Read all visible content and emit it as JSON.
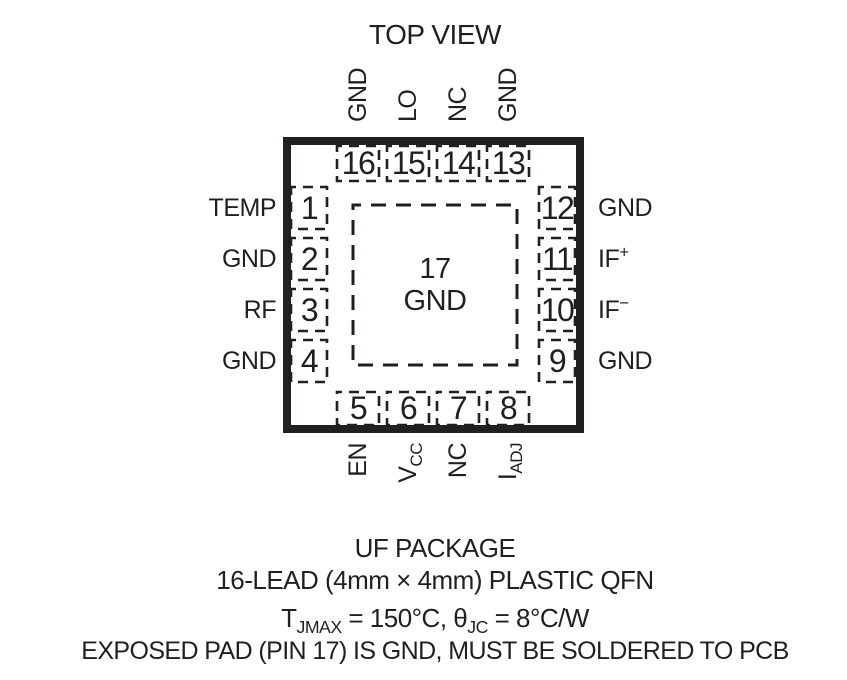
{
  "title": "TOP VIEW",
  "package": {
    "center_pad": {
      "number": "17",
      "label": "GND"
    },
    "pins": {
      "top": [
        {
          "number": "16",
          "label": {
            "base": "GND",
            "sub": "",
            "sup": ""
          }
        },
        {
          "number": "15",
          "label": {
            "base": "LO",
            "sub": "",
            "sup": ""
          }
        },
        {
          "number": "14",
          "label": {
            "base": "NC",
            "sub": "",
            "sup": ""
          }
        },
        {
          "number": "13",
          "label": {
            "base": "GND",
            "sub": "",
            "sup": ""
          }
        }
      ],
      "left": [
        {
          "number": "1",
          "label": {
            "base": "TEMP",
            "sub": "",
            "sup": ""
          }
        },
        {
          "number": "2",
          "label": {
            "base": "GND",
            "sub": "",
            "sup": ""
          }
        },
        {
          "number": "3",
          "label": {
            "base": "RF",
            "sub": "",
            "sup": ""
          }
        },
        {
          "number": "4",
          "label": {
            "base": "GND",
            "sub": "",
            "sup": ""
          }
        }
      ],
      "right": [
        {
          "number": "12",
          "label": {
            "base": "GND",
            "sub": "",
            "sup": ""
          }
        },
        {
          "number": "11",
          "label": {
            "base": "IF",
            "sub": "",
            "sup": "+"
          }
        },
        {
          "number": "10",
          "label": {
            "base": "IF",
            "sub": "",
            "sup": "−"
          }
        },
        {
          "number": "9",
          "label": {
            "base": "GND",
            "sub": "",
            "sup": ""
          }
        }
      ],
      "bottom": [
        {
          "number": "5",
          "label": {
            "base": "EN",
            "sub": "",
            "sup": ""
          }
        },
        {
          "number": "6",
          "label": {
            "base": "V",
            "sub": "CC",
            "sup": ""
          }
        },
        {
          "number": "7",
          "label": {
            "base": "NC",
            "sub": "",
            "sup": ""
          }
        },
        {
          "number": "8",
          "label": {
            "base": "I",
            "sub": "ADJ",
            "sup": ""
          }
        }
      ]
    }
  },
  "footer": {
    "package_name": "UF PACKAGE",
    "package_desc": "16-LEAD (4mm × 4mm) PLASTIC QFN",
    "thermal": {
      "t_base": "T",
      "t_sub": "JMAX",
      "t_mid": " = 150°C, ",
      "theta_base": "θ",
      "theta_sub": "JC",
      "theta_end": " = 8°C/W"
    },
    "note": "EXPOSED PAD (PIN 17) IS GND, MUST BE SOLDERED TO PCB"
  },
  "colors": {
    "ink": "#231f20",
    "background": "#ffffff"
  }
}
